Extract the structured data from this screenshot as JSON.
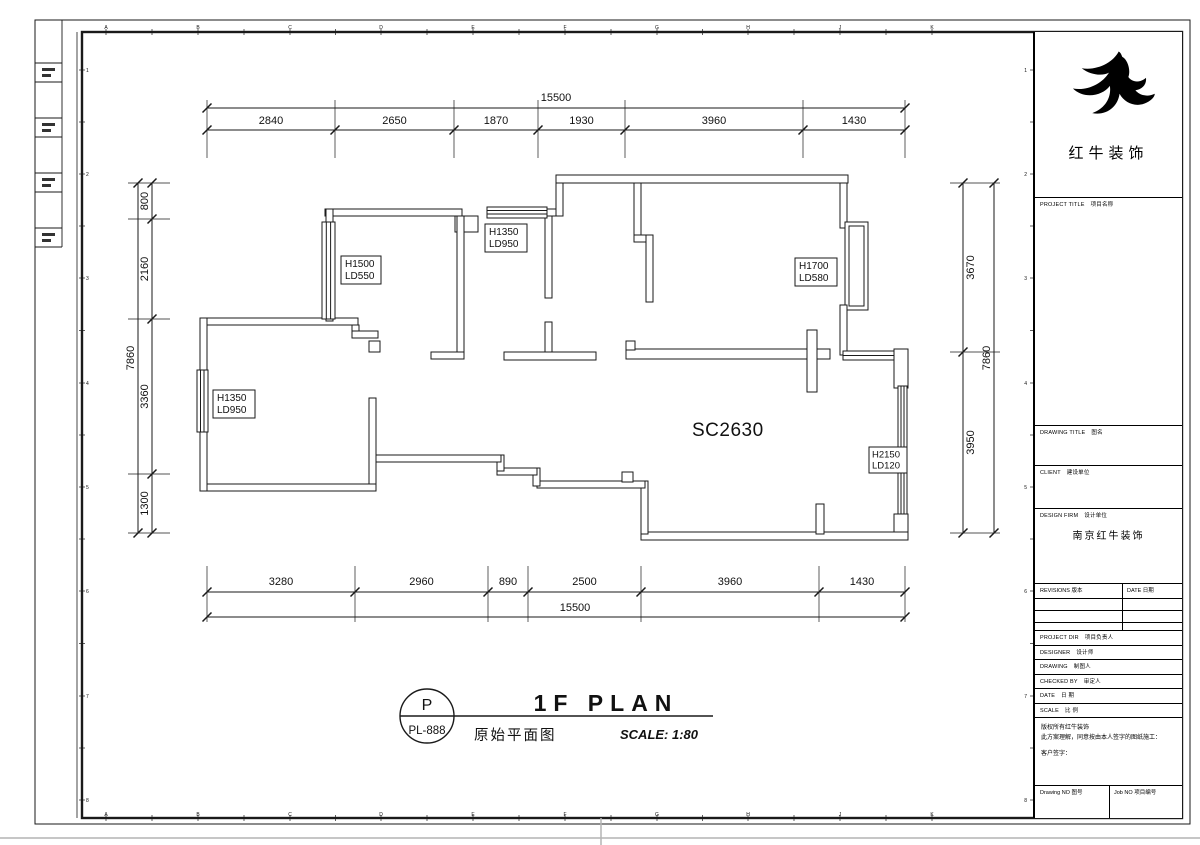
{
  "sheet": {
    "grid_letters": [
      "A",
      "B",
      "C",
      "D",
      "E",
      "F",
      "G",
      "H",
      "J",
      "K"
    ],
    "grid_numbers": [
      "1",
      "2",
      "3",
      "4",
      "5",
      "6",
      "7",
      "8"
    ]
  },
  "dims": {
    "top": {
      "total": "15500",
      "segments": [
        "2840",
        "2650",
        "1870",
        "1930",
        "3960",
        "1430"
      ]
    },
    "bottom": {
      "total": "15500",
      "segments": [
        "3280",
        "2960",
        "890",
        "2500",
        "3960",
        "1430"
      ]
    },
    "left": {
      "total": "7860",
      "segments": [
        "800",
        "2160",
        "3360",
        "1300"
      ]
    },
    "right": {
      "total": "7860",
      "segments": [
        "3670",
        "3950"
      ]
    }
  },
  "plan": {
    "room_labels": [
      {
        "h": "H1500",
        "ld": "LD550"
      },
      {
        "h": "H1350",
        "ld": "LD950"
      },
      {
        "h": "H1700",
        "ld": "LD580"
      },
      {
        "h": "H1350",
        "ld": "LD950"
      },
      {
        "h": "H2150",
        "ld": "LD120"
      }
    ],
    "sc_label": "SC2630"
  },
  "plan_title": {
    "symbol_letter": "P",
    "symbol_code": "PL-888",
    "title": "1F PLAN",
    "subtitle_zh": "原始平面图",
    "scale": "SCALE: 1:80"
  },
  "title_block": {
    "company": "红牛装饰",
    "project_title": {
      "en": "PROJECT TITLE",
      "zh": "项目名称"
    },
    "drawing_title": {
      "en": "DRAWING TITLE",
      "zh": "图名"
    },
    "client": {
      "en": "CLIENT",
      "zh": "建设单位"
    },
    "design_firm": {
      "en": "DESIGN FIRM",
      "zh": "设计单位",
      "value": "南京红牛装饰"
    },
    "revisions": {
      "en": "REVISIONS",
      "zh": "版本"
    },
    "date_col": {
      "en": "DATE",
      "zh": "日期"
    },
    "rows": [
      {
        "en": "PROJECT DIR",
        "zh": "项目负责人"
      },
      {
        "en": "DESIGNER",
        "zh": "设计师"
      },
      {
        "en": "DRAWING",
        "zh": "制图人"
      },
      {
        "en": "CHECKED BY",
        "zh": "审定人"
      },
      {
        "en": "DATE",
        "zh": "日 期"
      },
      {
        "en": "SCALE",
        "zh": "比 例"
      }
    ],
    "notes": [
      "版权所有红牛装饰",
      "此方案理解，同意按由本人签字的图纸施工：",
      "客户签字："
    ],
    "drawing_no": {
      "en": "Drawing NO",
      "zh": "图号"
    },
    "job_no": {
      "en": "Job NO",
      "zh": "项目编号"
    }
  }
}
